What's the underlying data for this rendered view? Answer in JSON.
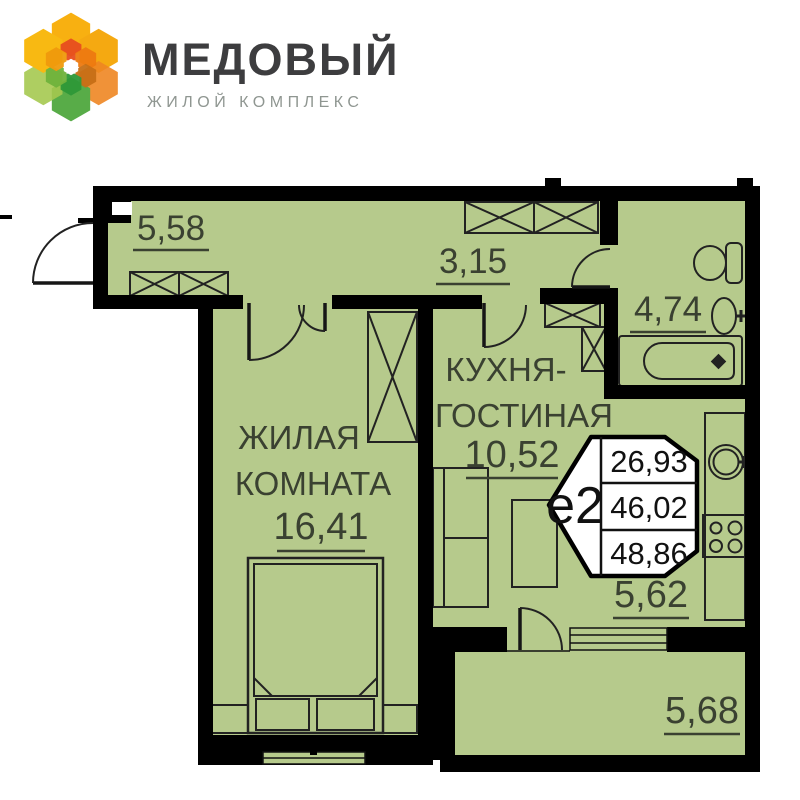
{
  "logo": {
    "title": "МЕДОВЫЙ",
    "subtitle": "ЖИЛОЙ КОМПЛЕКС"
  },
  "plan": {
    "rooms": {
      "hall": {
        "area": "5,58"
      },
      "corridor": {
        "area": "3,15"
      },
      "bathroom": {
        "area": "4,74"
      },
      "living_room": {
        "name_line1": "ЖИЛАЯ",
        "name_line2": "КОМНАТА",
        "area": "16,41"
      },
      "kitchen": {
        "name_line1": "КУХНЯ-",
        "name_line2": "ГОСТИНАЯ",
        "area": "10,52"
      },
      "kitchen_corridor": {
        "area": "5,62"
      },
      "balcony": {
        "area": "5,68"
      }
    },
    "badge": {
      "type_label": "е2",
      "living_area": "26,93",
      "main_area": "46,02",
      "total_area": "48,86"
    }
  },
  "colors": {
    "room_fill": "#b6ca8c",
    "wall": "#000000",
    "brand_orange": "#f7a600",
    "brand_green": "#76b83f",
    "logo_title_color": "#3d3d3f",
    "logo_subtitle_color": "#8f9691"
  }
}
